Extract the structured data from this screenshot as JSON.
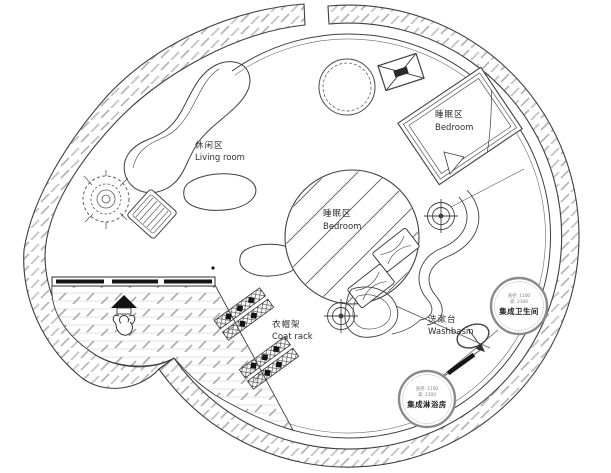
{
  "plan": {
    "living_room": {
      "zh": "休闲区",
      "en": "Living room"
    },
    "bedroom_upper": {
      "zh": "睡眠区",
      "en": "Bedroom"
    },
    "bedroom_center": {
      "zh": "睡眠区",
      "en": "Bedroom"
    },
    "coat_rack": {
      "zh": "衣帽架",
      "en": "Coat rack"
    },
    "washbasin": {
      "zh": "洗漱台",
      "en": "Washbasin"
    },
    "bathroom_pod": {
      "dim_line1": "直径: 1100",
      "dim_line2": "高: 2100",
      "name": "集成卫生间"
    },
    "shower_pod": {
      "dim_line1": "直径: 1100",
      "dim_line2": "高: 2100",
      "name": "集成淋浴房"
    },
    "colors": {
      "line": "#3f3f3f",
      "wall_hatch": "#b5b5b5",
      "floor_line": "#d8d8d8",
      "floor_dash": "#adadad",
      "black": "#141414",
      "pod_ring": "#8a8a8a",
      "background": "#ffffff"
    }
  }
}
